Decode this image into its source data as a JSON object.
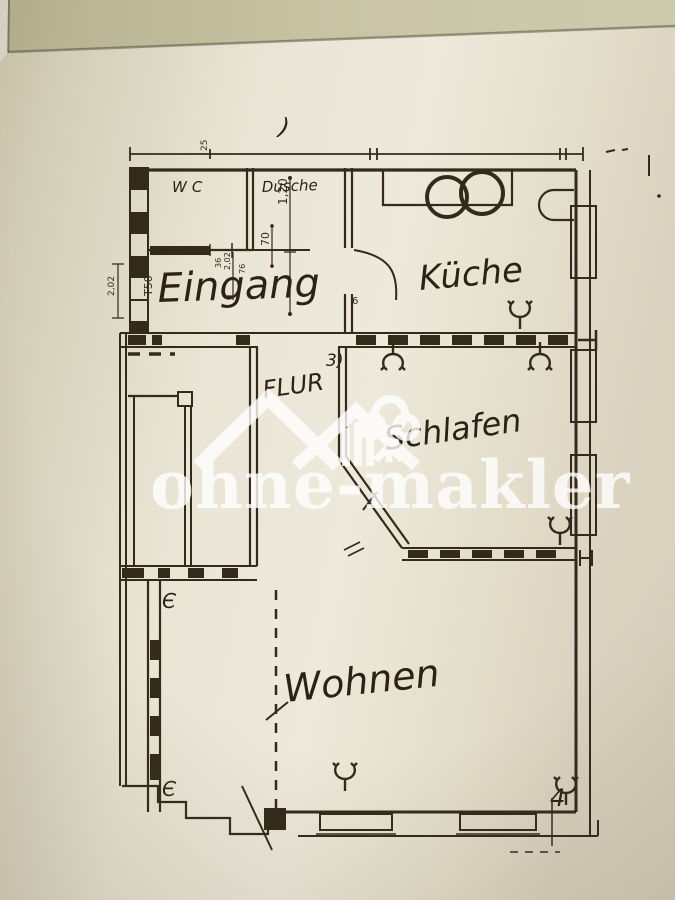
{
  "colors": {
    "ink": "#332a1c",
    "paper": "#e9e4d5",
    "desk": "#c6c2a2",
    "watermark": "#ffffff"
  },
  "watermark": {
    "brand": "ohne-makler"
  },
  "plan": {
    "labels": {
      "wc": "WC",
      "dusche": "Dusche",
      "kueche": "Küche",
      "eingang": "Eingang",
      "flur": "FLUR",
      "schlafen": "Schlafen",
      "wohnen": "Wohnen"
    },
    "dims": {
      "top": "25",
      "w120": "1,20",
      "w70": "70",
      "d36": "36",
      "d202": "2,02",
      "d76": "76",
      "t50": "T50",
      "h202": "2,02",
      "k6": "6"
    },
    "marks": {
      "paren": ")",
      "door3": "3)",
      "corner4": "4",
      "swingTop": "Є",
      "swingBottom": "Є"
    }
  }
}
